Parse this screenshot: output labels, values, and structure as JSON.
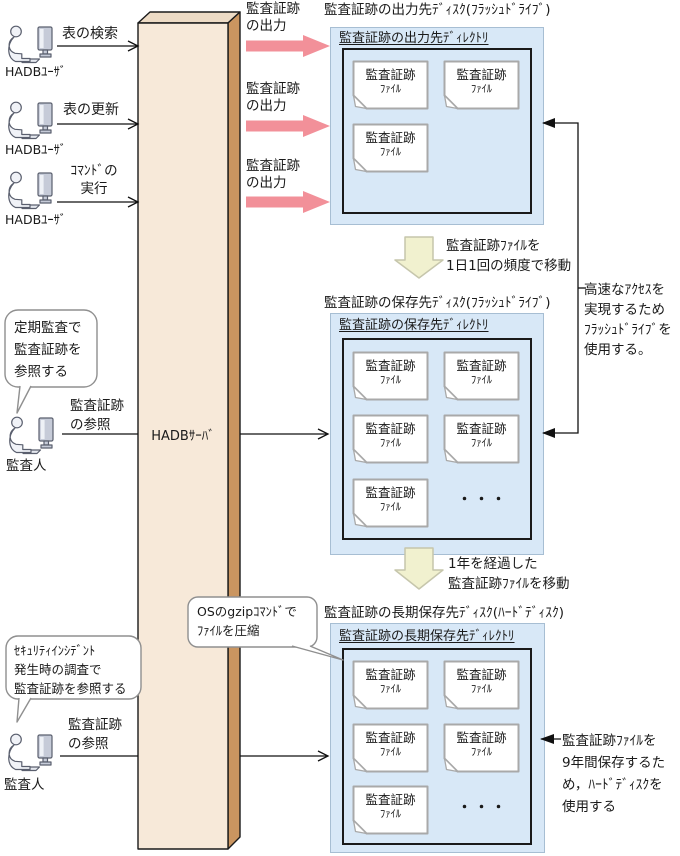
{
  "users": [
    {
      "label": "HADBﾕｰｻﾞ",
      "action": "表の検索"
    },
    {
      "label": "HADBﾕｰｻﾞ",
      "action": "表の更新"
    },
    {
      "label": "HADBﾕｰｻﾞ",
      "action_line1": "ｺﾏﾝﾄﾞの",
      "action_line2": "実行"
    }
  ],
  "server_label": "HADBｻｰﾊﾞ",
  "output_arrow_label": {
    "line1": "監査証跡",
    "line2": "の出力"
  },
  "disks": {
    "output": {
      "title": "監査証跡の出力先ﾃﾞｨｽｸ(ﾌﾗｯｼｭﾄﾞﾗｲﾌﾞ)",
      "directory": "監査証跡の出力先ﾃﾞｨﾚｸﾄﾘ",
      "file_count": 3
    },
    "save": {
      "title": "監査証跡の保存先ﾃﾞｨｽｸ(ﾌﾗｯｼｭﾄﾞﾗｲﾌﾞ)",
      "directory": "監査証跡の保存先ﾃﾞｨﾚｸﾄﾘ",
      "file_count": 5,
      "ellipsis": "・・・"
    },
    "longterm": {
      "title": "監査証跡の長期保存先ﾃﾞｨｽｸ(ﾊｰﾄﾞﾃﾞｨｽｸ)",
      "directory": "監査証跡の長期保存先ﾃﾞｨﾚｸﾄﾘ",
      "file_count": 5,
      "ellipsis": "・・・"
    }
  },
  "file_label": {
    "line1": "監査証跡",
    "line2": "ﾌｧｲﾙ"
  },
  "moves": {
    "daily": {
      "line1": "監査証跡ﾌｧｲﾙを",
      "line2": "1日1回の頻度で移動"
    },
    "yearly": {
      "line1": "1年を経過した",
      "line2": "監査証跡ﾌｧｲﾙを移動"
    }
  },
  "notes": {
    "flash": {
      "line1": "高速なｱｸｾｽを",
      "line2": "実現するため",
      "line3": "ﾌﾗｯｼｭﾄﾞﾗｲﾌﾞを",
      "line4": "使用する。"
    },
    "hdd": {
      "line1": "監査証跡ﾌｧｲﾙを",
      "line2": "9年間保存するた",
      "line3": "め，ﾊｰﾄﾞﾃﾞｨｽｸを",
      "line4": "使用する"
    },
    "gzip": {
      "line1": "OSのgzipｺﾏﾝﾄﾞで",
      "line2": "ﾌｧｲﾙを圧縮"
    }
  },
  "auditors": [
    {
      "bubble_line1": "定期監査で",
      "bubble_line2": "監査証跡を",
      "bubble_line3": "参照する",
      "label": "監査人",
      "action_line1": "監査証跡",
      "action_line2": "の参照"
    },
    {
      "bubble_line1": "ｾｷｭﾘﾃｨｲﾝｼﾃﾞﾝﾄ",
      "bubble_line2": "発生時の調査で",
      "bubble_line3": "監査証跡を参照する",
      "label": "監査人",
      "action_line1": "監査証跡",
      "action_line2": "の参照"
    }
  ],
  "colors": {
    "disk_fill": "#d8e8f7",
    "disk_border": "#a7bed3",
    "server_front": "#f7e9d9",
    "server_side": "#ca9560",
    "server_top": "#eddbc5",
    "arrow_pink": "#f29099",
    "arrow_yellow": "#f1f1cf",
    "file_border": "#a9a9a9"
  }
}
